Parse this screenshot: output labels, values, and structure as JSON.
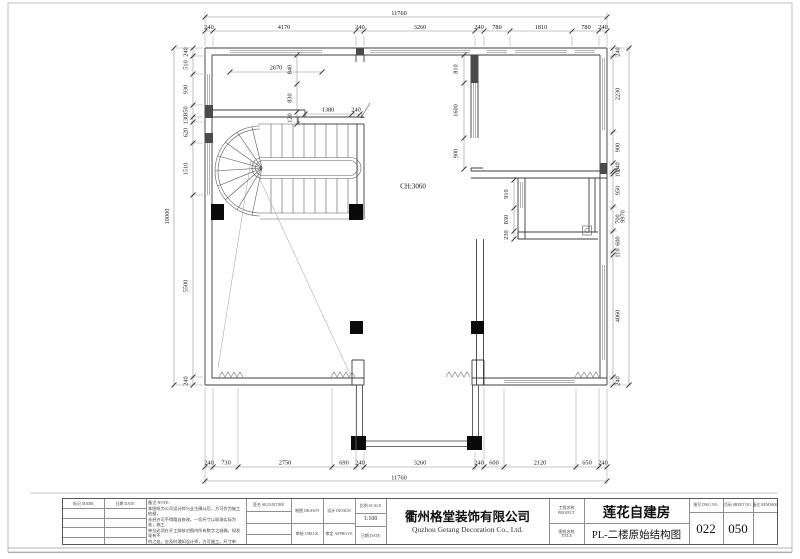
{
  "sheet": {
    "ceiling_note": "CH:3060",
    "dims": {
      "top_total": "11760",
      "top": [
        "240",
        "4170",
        "240",
        "3260",
        "240",
        "780",
        "1810",
        "780",
        "240"
      ],
      "bottom": [
        "240",
        "730",
        "2750",
        "690",
        "240",
        "3260",
        "240",
        "600",
        "2120",
        "650",
        "240"
      ],
      "bottom_total": "11760",
      "left": [
        "240",
        "510",
        "930",
        "350",
        "130",
        "620",
        "1510",
        "5500",
        "240"
      ],
      "left_total": "10000",
      "right": [
        "240",
        "2230",
        "900",
        "240",
        "100",
        "950",
        "700",
        "600",
        "110",
        "4060",
        "240"
      ],
      "right_total": "9970",
      "interior": {
        "win_tl": "2670",
        "v840": "840",
        "v830": "830",
        "v120": "120",
        "h1380": "1380",
        "h240": "240",
        "v810": "810",
        "v1600": "1600",
        "v900": "900",
        "v910": "910",
        "v830b": "830",
        "v230": "230"
      }
    }
  },
  "title_block": {
    "mark_label": "标记 MARK",
    "date_label": "日期 DATE",
    "note_label": "备注 NOTE:",
    "notes": [
      "本图纸为公司设计师与业主确认后，方可作为施工依据，",
      "未经许可不得擅自修改。一切尺寸以现场实际为准，施工",
      "单位必须在开工前核对图内所有数字之准确，如发现有不",
      "符之处，应及时通知设计师，方可施工。尺寸单位：均以",
      "毫米(mm)计。"
    ],
    "sign_label": "签名 SIGNATURE",
    "drawn_label": "制图 DRAWN",
    "design_label": "设计 DESIGN",
    "scale_label": "比例 SCALE",
    "scale_value": "1:100",
    "check_label": "审核 CHECK",
    "approve_label": "审定 APPROVE",
    "date2_label": "日期 DATE",
    "company_cn": "衢州格堂装饰有限公司",
    "company_en": "Quzhou Getang Decoration Co., Ltd.",
    "project_label_cn": "工程名称",
    "project_label_en": "PROJECT",
    "drawing_label_cn": "图纸名称",
    "drawing_label_en": "TITLE",
    "project_name": "莲花自建房",
    "drawing_name": "PL-二楼原始结构图",
    "dwgno_label": "图号 DWG NO.",
    "dwgno": "022",
    "sheet_label": "页码 SHEET NO.",
    "sheet_no": "050",
    "remark_label": "备注 REMARK",
    "remark_value": ""
  }
}
